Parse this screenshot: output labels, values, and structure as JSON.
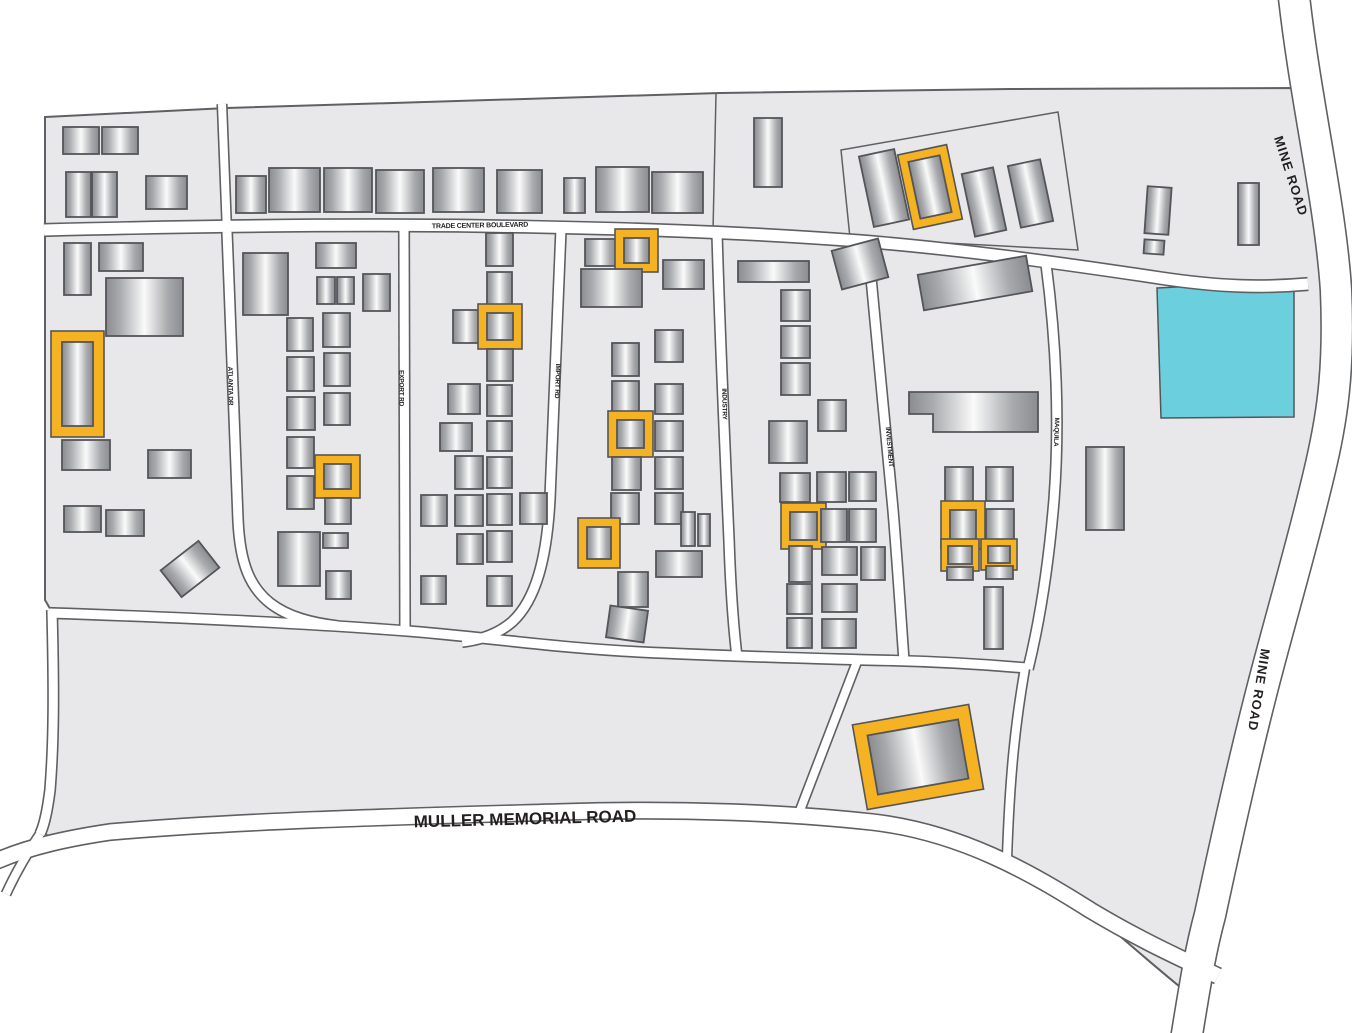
{
  "map": {
    "colors": {
      "background": "#ffffff",
      "land": "#e8e8ea",
      "land_stroke": "#5f6063",
      "road_fill": "#ffffff",
      "road_casing": "#5f6063",
      "building_stroke": "#545559",
      "building_dark": "#8a8c8f",
      "building_mid": "#a8aaad",
      "building_light": "#fafafa",
      "highlight": "#f5b324",
      "water": "#6ccfde",
      "label_color": "#231f20"
    },
    "land_path": "M45,117 L227,108 L720,93 L1010,89 L1295,88 C1310,160 1330,220 1336,290 C1340,380 1330,430 1315,490 C1298,560 1280,620 1262,690 C1244,760 1225,845 1210,915 C1202,945 1196,966 1190,995 C1165,975 1130,945 1090,910 C1030,872 960,832 872,822 C790,813 680,808 560,812 C420,816 250,820 110,832 C80,835 58,840 44,834 C47,822 49,808 50,790 C54,740 54,680 52,612 L45,600 Z",
    "parcel_lines": [
      "M850,238 L841,150 L1058,112 L1078,250 Z",
      "M716,94 L713,231"
    ],
    "water_parcel": "M1157,288 L1294,281 L1294,417 L1161,418 Z",
    "roads": [
      {
        "name": "mine-road",
        "d": "M1293,-12 C1305,100 1330,200 1336,290 C1340,380 1330,430 1315,490 C1298,560 1280,620 1262,690 C1244,760 1225,845 1210,915 C1200,952 1195,985 1186,1040",
        "w": 30
      },
      {
        "name": "trade-center-boulevard",
        "d": "M44,230 C200,226 340,224 480,226 C620,228 740,232 860,241 C960,249 1060,263 1160,278 C1220,287 1262,288 1308,284",
        "w": 11
      },
      {
        "name": "north-stub-road",
        "d": "M222,104 L227,232",
        "w": 8
      },
      {
        "name": "atlanta-dr",
        "d": "M227,232 C231,330 234,430 238,520 C240,564 250,587 270,603 C288,617 312,623 338,626",
        "w": 9
      },
      {
        "name": "export-rd",
        "d": "M404,228 L405,631",
        "w": 9
      },
      {
        "name": "import-rd",
        "d": "M561,229 C557,330 554,420 550,498 C547,558 536,600 512,622 C498,634 480,640 462,642",
        "w": 9
      },
      {
        "name": "industry-rd",
        "d": "M717,233 C720,340 725,450 729,540 C731,600 734,632 737,657",
        "w": 9
      },
      {
        "name": "investment-rd",
        "d": "M868,246 C876,330 885,420 893,510 C898,570 901,620 904,661",
        "w": 9
      },
      {
        "name": "maquila-rd",
        "d": "M1046,264 C1056,340 1060,420 1054,500 C1049,560 1040,620 1028,669",
        "w": 9
      },
      {
        "name": "south-service-road",
        "d": "M49,613 C200,618 320,624 420,632 C500,639 560,648 640,652 C720,656 800,658 868,660 C930,661 980,664 1026,668",
        "w": 9
      },
      {
        "name": "parcel-road-west",
        "d": "M858,659 L799,813",
        "w": 8
      },
      {
        "name": "parcel-road-east",
        "d": "M1025,668 C1016,720 1010,770 1007,858",
        "w": 8
      },
      {
        "name": "west-road",
        "d": "M52,610 C54,690 54,740 50,790 C47,814 44,826 40,834",
        "w": 9
      },
      {
        "name": "muller-memorial-road",
        "d": "M-6,862 C30,846 70,838 110,832 C250,820 420,816 560,812 C680,808 790,813 872,822 C960,832 1030,872 1090,910 C1140,940 1180,958 1218,976",
        "w": 15
      },
      {
        "name": "southwest-stub",
        "d": "M40,834 C28,852 16,872 6,894",
        "w": 8
      }
    ],
    "labels": [
      {
        "text": "MINE ROAD",
        "x": 1291,
        "y": 176,
        "rot": 72,
        "size": 13,
        "ls": 1
      },
      {
        "text": "MINE ROAD",
        "x": 1259,
        "y": 690,
        "rot": 99,
        "size": 13,
        "ls": 1
      },
      {
        "text": "TRADE CENTER BOULEVARD",
        "x": 480,
        "y": 226,
        "rot": -1,
        "size": 7,
        "ls": -0.2
      },
      {
        "text": "ATLANTA DR",
        "x": 230,
        "y": 386,
        "rot": 89,
        "size": 6.5,
        "ls": -0.2
      },
      {
        "text": "EXPORT RD",
        "x": 401,
        "y": 388,
        "rot": 90,
        "size": 6.5,
        "ls": -0.2
      },
      {
        "text": "IMPORT RD",
        "x": 557,
        "y": 381,
        "rot": 92,
        "size": 6.5,
        "ls": -0.2
      },
      {
        "text": "INDUSTRY",
        "x": 724,
        "y": 404,
        "rot": 89,
        "size": 6.5,
        "ls": -0.2
      },
      {
        "text": "INVESTMENT",
        "x": 889,
        "y": 447,
        "rot": 85,
        "size": 6.5,
        "ls": -0.2
      },
      {
        "text": "MAQUILA",
        "x": 1056,
        "y": 432,
        "rot": 92,
        "size": 6.5,
        "ls": -0.2
      },
      {
        "text": "MULLER MEMORIAL ROAD",
        "x": 525,
        "y": 819,
        "rot": -1.5,
        "size": 17,
        "ls": 0
      }
    ],
    "l_shape_building": [
      [
        909,
        392
      ],
      [
        1038,
        392
      ],
      [
        1038,
        432
      ],
      [
        933,
        432
      ],
      [
        933,
        414
      ],
      [
        909,
        414
      ]
    ],
    "buildings": [
      [
        63,
        127,
        36,
        27
      ],
      [
        102,
        127,
        36,
        27
      ],
      [
        66,
        172,
        25,
        45
      ],
      [
        92,
        172,
        25,
        45
      ],
      [
        146,
        176,
        41,
        33
      ],
      [
        236,
        176,
        30,
        37
      ],
      [
        269,
        168,
        51,
        44
      ],
      [
        324,
        168,
        48,
        44
      ],
      [
        376,
        170,
        48,
        43
      ],
      [
        433,
        168,
        51,
        44
      ],
      [
        497,
        170,
        45,
        43
      ],
      [
        564,
        178,
        21,
        35
      ],
      [
        596,
        167,
        53,
        45
      ],
      [
        652,
        172,
        51,
        41
      ],
      [
        754,
        118,
        28,
        69
      ],
      [
        866,
        152,
        36,
        72,
        -12
      ],
      [
        914,
        158,
        32,
        58,
        -12,
        1
      ],
      [
        968,
        170,
        32,
        64,
        -12
      ],
      [
        1014,
        162,
        33,
        63,
        -12
      ],
      [
        1146,
        187,
        24,
        47,
        4
      ],
      [
        1144,
        240,
        20,
        14,
        4
      ],
      [
        1238,
        183,
        21,
        62
      ],
      [
        64,
        243,
        27,
        52
      ],
      [
        99,
        243,
        44,
        28
      ],
      [
        106,
        278,
        77,
        58
      ],
      [
        62,
        342,
        31,
        84,
        0,
        1,
        11
      ],
      [
        62,
        440,
        48,
        30
      ],
      [
        148,
        450,
        43,
        28
      ],
      [
        64,
        506,
        37,
        26
      ],
      [
        106,
        510,
        38,
        26
      ],
      [
        166,
        552,
        48,
        34,
        -38
      ],
      [
        243,
        253,
        45,
        62
      ],
      [
        316,
        243,
        40,
        25
      ],
      [
        317,
        277,
        18,
        27
      ],
      [
        337,
        277,
        17,
        27
      ],
      [
        363,
        274,
        27,
        37
      ],
      [
        287,
        318,
        26,
        33
      ],
      [
        287,
        357,
        27,
        34
      ],
      [
        287,
        397,
        28,
        33
      ],
      [
        287,
        437,
        27,
        31
      ],
      [
        287,
        476,
        27,
        33
      ],
      [
        323,
        313,
        27,
        34
      ],
      [
        324,
        353,
        26,
        33
      ],
      [
        324,
        393,
        26,
        32
      ],
      [
        324,
        464,
        27,
        25,
        0,
        1
      ],
      [
        325,
        498,
        26,
        26
      ],
      [
        323,
        533,
        25,
        15
      ],
      [
        326,
        571,
        25,
        28
      ],
      [
        278,
        532,
        42,
        54
      ],
      [
        486,
        233,
        27,
        33
      ],
      [
        487,
        272,
        25,
        33
      ],
      [
        453,
        310,
        27,
        33
      ],
      [
        487,
        313,
        26,
        27,
        0,
        1
      ],
      [
        487,
        349,
        26,
        32
      ],
      [
        448,
        384,
        32,
        30
      ],
      [
        487,
        385,
        25,
        31
      ],
      [
        440,
        423,
        32,
        28
      ],
      [
        487,
        421,
        25,
        30
      ],
      [
        455,
        456,
        28,
        33
      ],
      [
        487,
        457,
        25,
        31
      ],
      [
        421,
        495,
        26,
        31
      ],
      [
        455,
        495,
        28,
        31
      ],
      [
        487,
        494,
        25,
        31
      ],
      [
        520,
        493,
        27,
        31
      ],
      [
        457,
        534,
        26,
        30
      ],
      [
        487,
        531,
        25,
        31
      ],
      [
        421,
        576,
        25,
        28
      ],
      [
        487,
        576,
        25,
        30
      ],
      [
        585,
        239,
        31,
        27
      ],
      [
        624,
        238,
        25,
        25,
        0,
        1
      ],
      [
        581,
        269,
        61,
        38
      ],
      [
        663,
        260,
        41,
        29
      ],
      [
        612,
        343,
        27,
        33
      ],
      [
        612,
        381,
        27,
        33
      ],
      [
        617,
        420,
        27,
        28,
        0,
        1
      ],
      [
        612,
        457,
        29,
        33
      ],
      [
        611,
        493,
        28,
        31
      ],
      [
        655,
        330,
        28,
        32
      ],
      [
        655,
        384,
        28,
        30
      ],
      [
        655,
        421,
        28,
        30
      ],
      [
        655,
        457,
        28,
        32
      ],
      [
        655,
        493,
        28,
        31
      ],
      [
        681,
        512,
        14,
        34
      ],
      [
        698,
        514,
        12,
        32
      ],
      [
        587,
        527,
        24,
        32,
        0,
        1
      ],
      [
        656,
        551,
        46,
        26
      ],
      [
        618,
        572,
        30,
        35
      ],
      [
        608,
        608,
        38,
        32,
        8
      ],
      [
        738,
        261,
        71,
        21
      ],
      [
        836,
        244,
        48,
        40,
        -15
      ],
      [
        781,
        290,
        29,
        31
      ],
      [
        781,
        326,
        29,
        32
      ],
      [
        781,
        363,
        29,
        32
      ],
      [
        818,
        400,
        28,
        31
      ],
      [
        769,
        421,
        38,
        42
      ],
      [
        780,
        473,
        30,
        29
      ],
      [
        817,
        472,
        29,
        30
      ],
      [
        849,
        472,
        27,
        29
      ],
      [
        790,
        512,
        27,
        28,
        0,
        1
      ],
      [
        821,
        509,
        26,
        33
      ],
      [
        849,
        509,
        27,
        33
      ],
      [
        789,
        546,
        23,
        36
      ],
      [
        822,
        547,
        35,
        28
      ],
      [
        861,
        547,
        24,
        33
      ],
      [
        787,
        584,
        25,
        30
      ],
      [
        822,
        584,
        35,
        28
      ],
      [
        787,
        618,
        25,
        30
      ],
      [
        822,
        619,
        34,
        29
      ],
      [
        920,
        265,
        110,
        36,
        -10
      ],
      [
        945,
        467,
        28,
        36
      ],
      [
        986,
        467,
        27,
        34
      ],
      [
        950,
        510,
        26,
        30,
        0,
        1
      ],
      [
        986,
        509,
        28,
        32
      ],
      [
        948,
        546,
        24,
        18,
        0,
        1,
        7
      ],
      [
        988,
        546,
        22,
        17,
        0,
        1,
        7
      ],
      [
        947,
        567,
        26,
        13
      ],
      [
        986,
        566,
        27,
        13
      ],
      [
        984,
        587,
        19,
        62
      ],
      [
        1086,
        447,
        38,
        83
      ],
      [
        872,
        727,
        92,
        60,
        -10,
        1,
        13
      ]
    ]
  }
}
